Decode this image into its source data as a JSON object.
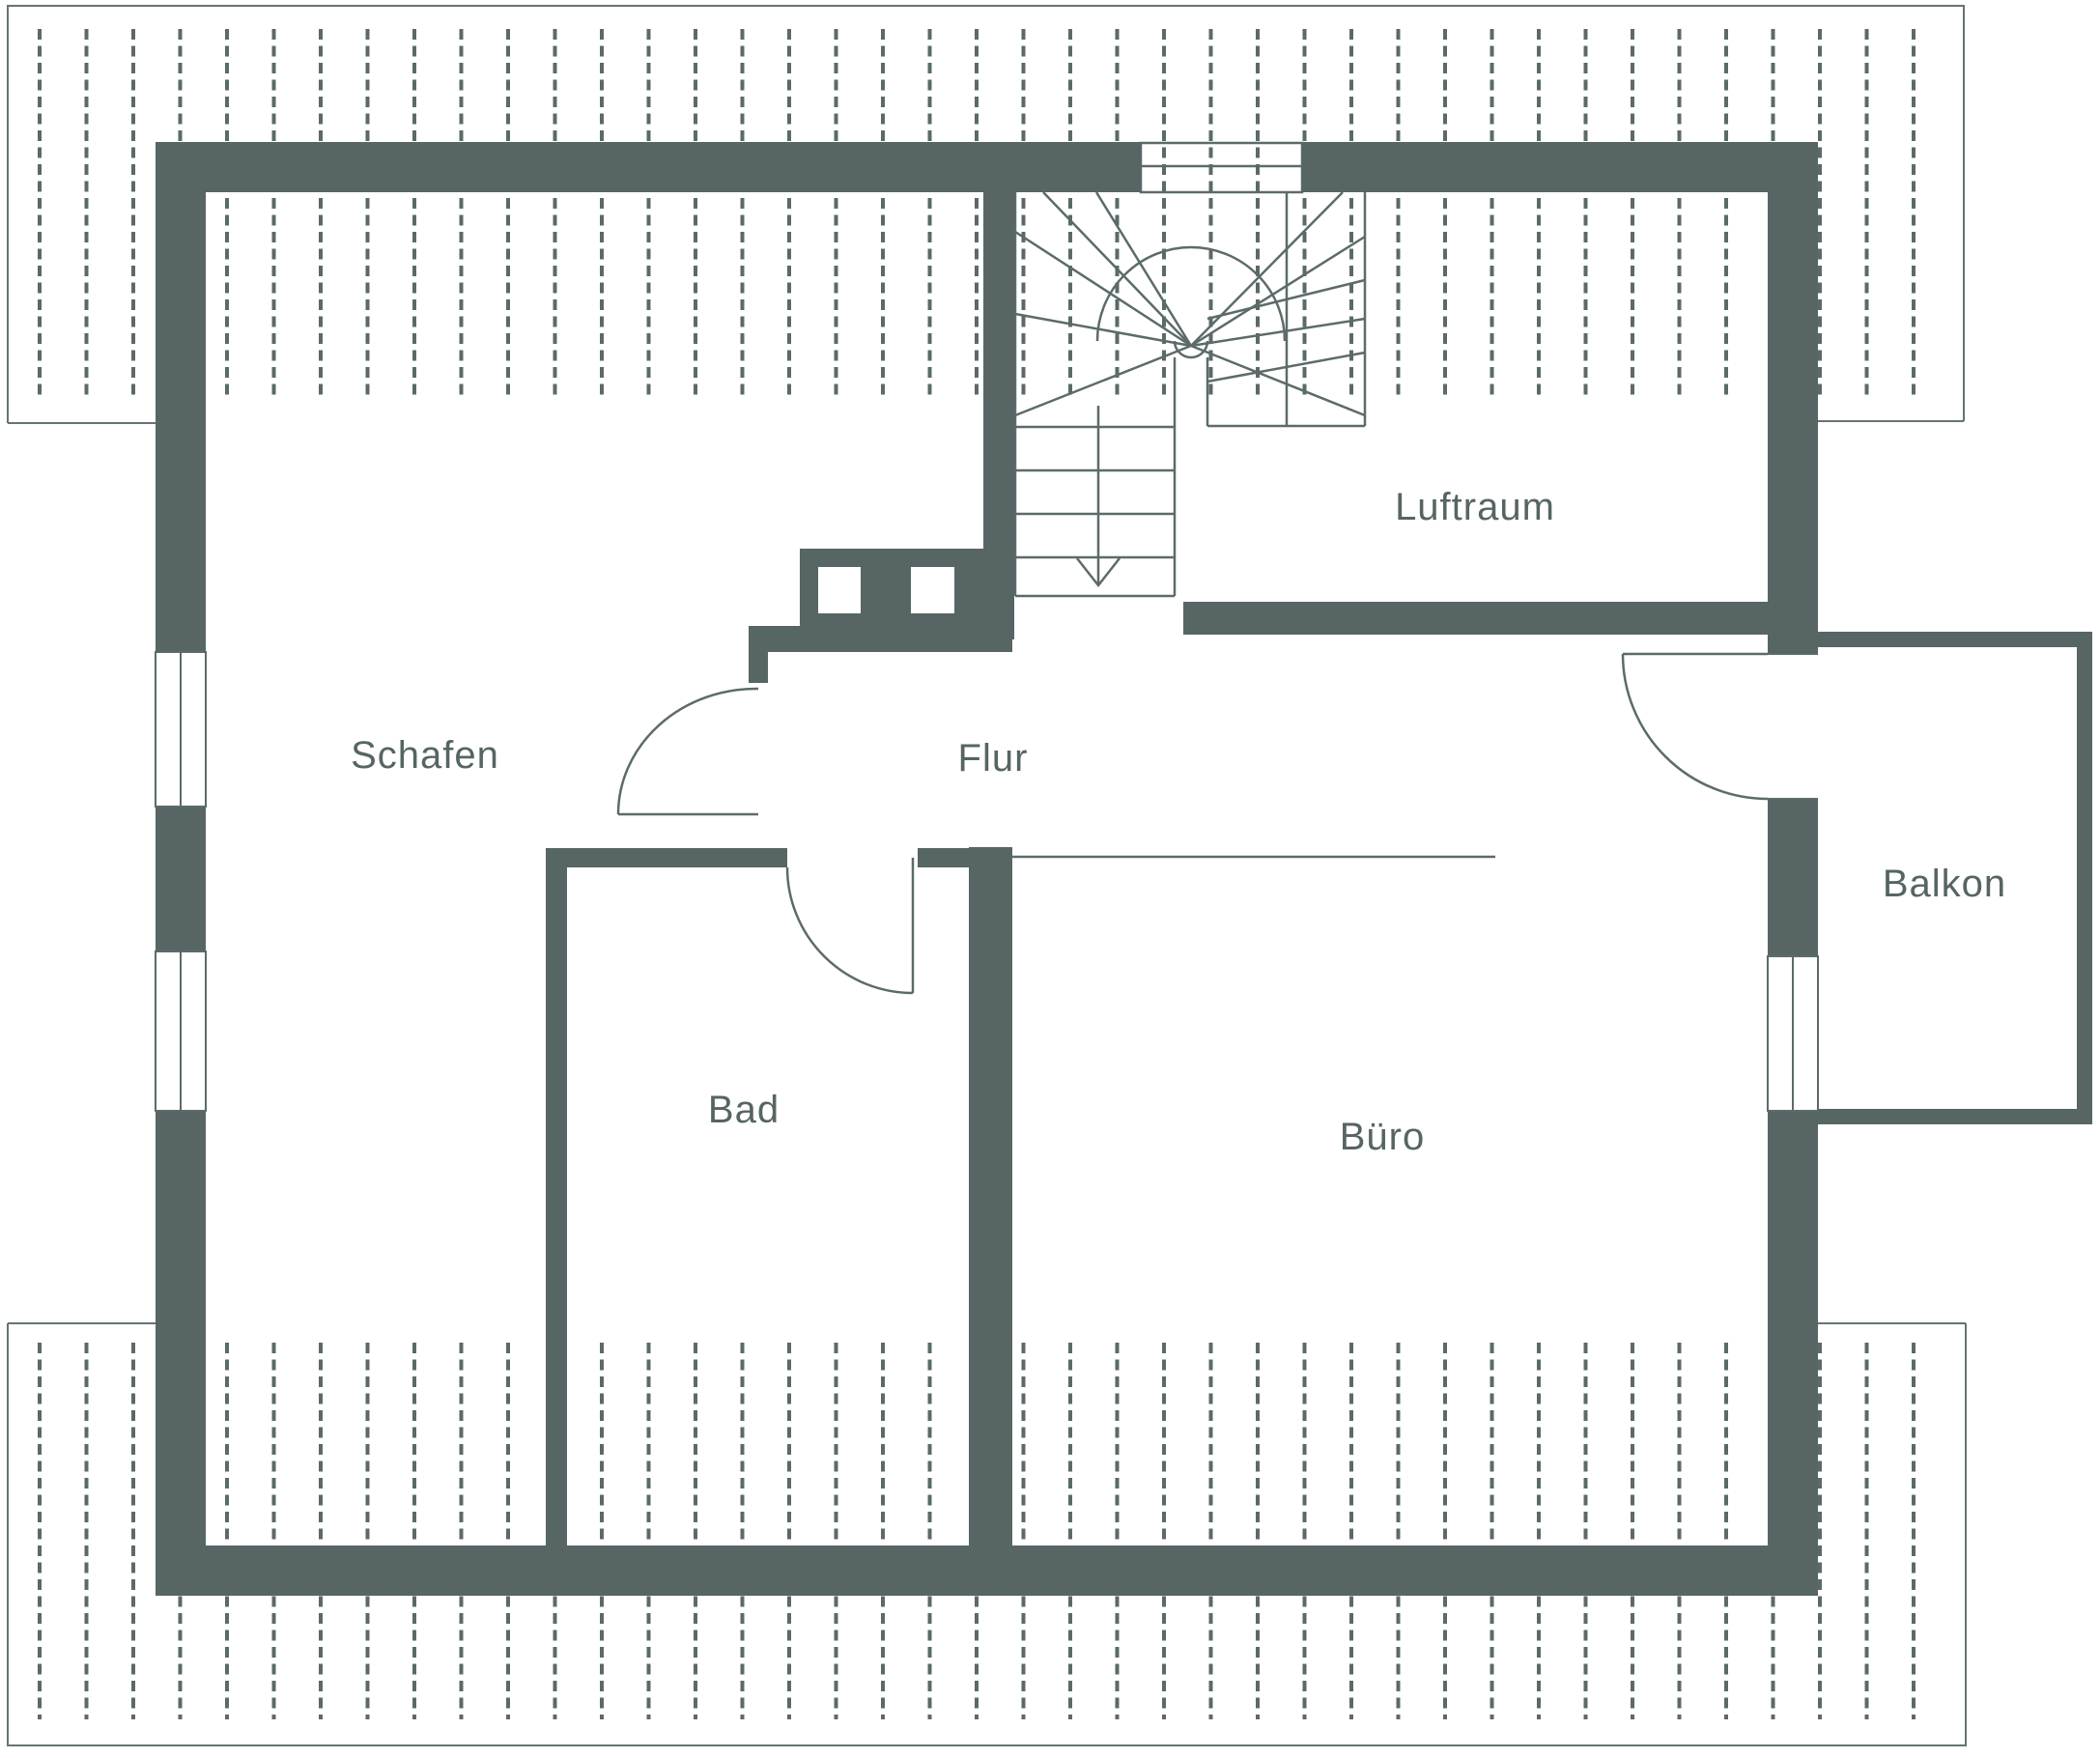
{
  "drawing": {
    "type": "floor-plan",
    "floor": "attic"
  },
  "colors": {
    "background": "#ffffff",
    "wall": "#576665",
    "line": "#5c6b6a",
    "roof": "#657473",
    "hatch": "#5b6a69",
    "text": "#566564"
  },
  "rooms": [
    {
      "id": "schafen",
      "label": "Schafen"
    },
    {
      "id": "flur",
      "label": "Flur"
    },
    {
      "id": "luftraum",
      "label": "Luftraum"
    },
    {
      "id": "bad",
      "label": "Bad"
    },
    {
      "id": "buero",
      "label": "Büro"
    },
    {
      "id": "balkon",
      "label": "Balkon"
    }
  ],
  "stairs": {
    "arrow": "down"
  }
}
